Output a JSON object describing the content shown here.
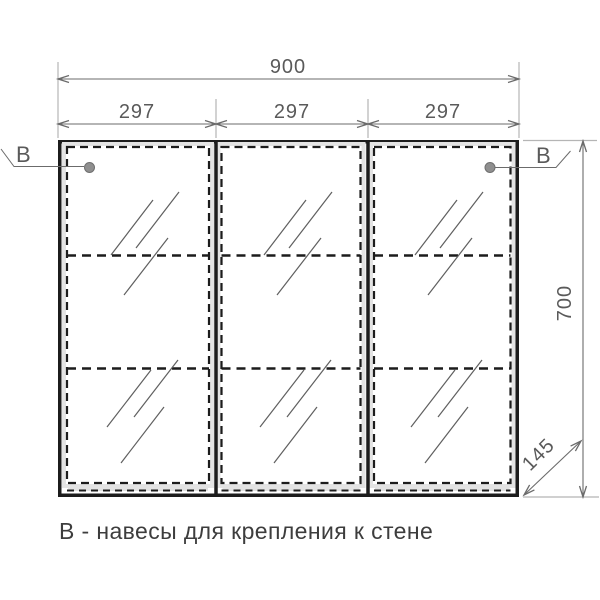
{
  "drawing": {
    "dimensions": {
      "overall_width": "900",
      "door_widths": [
        "297",
        "297",
        "297"
      ],
      "height": "700",
      "depth": "145"
    },
    "annotations": {
      "hinge_label_left": "В",
      "hinge_label_right": "В",
      "caption": "В - навесы для крепления к стене"
    },
    "colors": {
      "outline": "#1c1c1c",
      "dimension_line": "#6b6b6b",
      "dimension_text": "#5a5a5a",
      "extension_line": "#b5b5b5",
      "carcass_band": "#e3e3e3",
      "hinge_dot": "#8f8f8f",
      "glass_hatch": "#5f5f5f",
      "caption_text": "#3d3d3d",
      "background": "#ffffff"
    }
  }
}
